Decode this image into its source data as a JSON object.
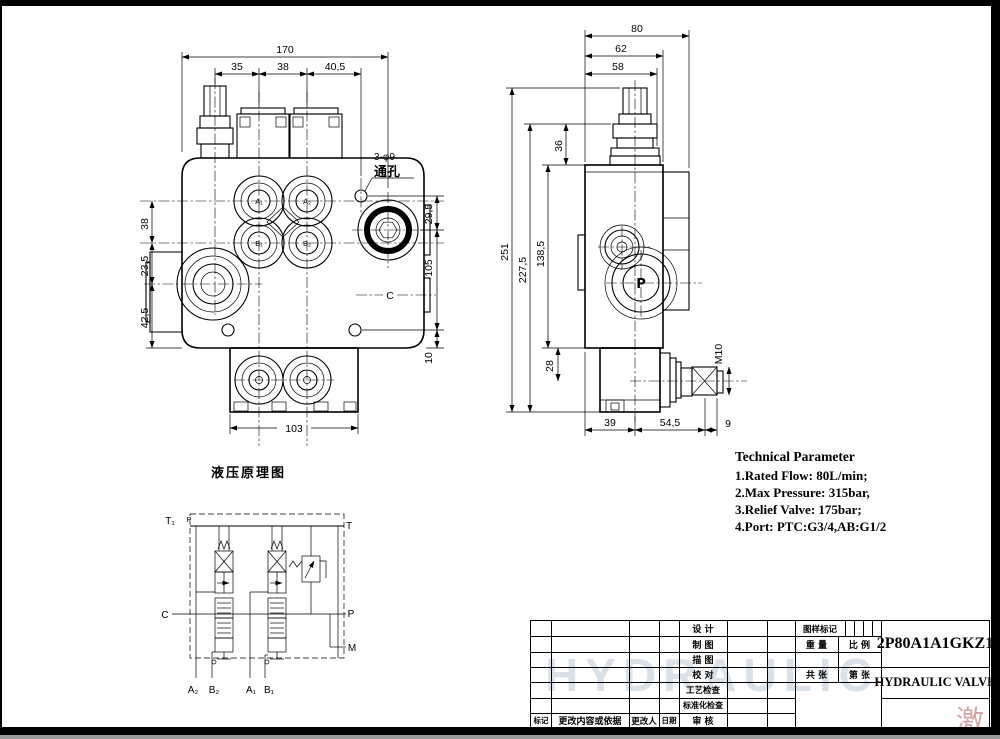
{
  "front_view": {
    "dims": {
      "total_width": "170",
      "seg_35": "35",
      "seg_38": "38",
      "seg_40_5": "40,5",
      "left_38": "38",
      "left_23_5": "23,5",
      "left_42_5": "42,5",
      "right_29_5": "29,5",
      "right_105": "105",
      "right_10": "10",
      "bottom_103": "103"
    },
    "hole_note_line1": "3-φ9",
    "hole_note_line2": "通孔",
    "port_c_label": "C",
    "ports": {
      "a1": "A₁",
      "a2": "A₂",
      "b1": "B₁",
      "b2": "B₂"
    }
  },
  "side_view": {
    "dims": {
      "top_80": "80",
      "top_62": "62",
      "top_58": "58",
      "left_251": "251",
      "left_227_5": "227,5",
      "left_138_5": "138,5",
      "left_36": "36",
      "left_28": "28",
      "bottom_39": "39",
      "bottom_54_5": "54,5",
      "bottom_9": "9"
    },
    "thread_label": "M10",
    "port_p_label": "P"
  },
  "schematic": {
    "title": "液压原理图",
    "labels": {
      "t1": "T₁",
      "p_top": "P",
      "t": "T",
      "c": "C",
      "p_right": "P",
      "m": "M",
      "a2": "A₂",
      "b2": "B₂",
      "a1": "A₁",
      "b1": "B₁"
    }
  },
  "tech_params": {
    "title": "Technical Parameter",
    "line1": "1.Rated Flow:  80L/min;",
    "line2": "2.Max Pressure:  315bar,",
    "line3": "3.Relief Valve:  175bar;",
    "line4": "4.Port:  PTC:G3/4,AB:G1/2"
  },
  "title_block": {
    "model": "2P80A1A1GKZ1",
    "product": "HYDRAULIC VALVE",
    "proc_rows": [
      "设 计",
      "制 图",
      "描 图",
      "校 对",
      "工艺检查",
      "标准化检查",
      "审 核"
    ],
    "rev_cols": {
      "mark": "标记",
      "change": "更改内容或依据",
      "changer": "更改人",
      "date": "日期"
    },
    "fields": {
      "drawing_mark": "图样标记",
      "weight": "重 量",
      "scale": "比 例",
      "sheets_total": "共 张",
      "sheet_no": "第 张"
    },
    "watermark_bg": "HYDRAULIC",
    "watermark_corner": "激"
  }
}
